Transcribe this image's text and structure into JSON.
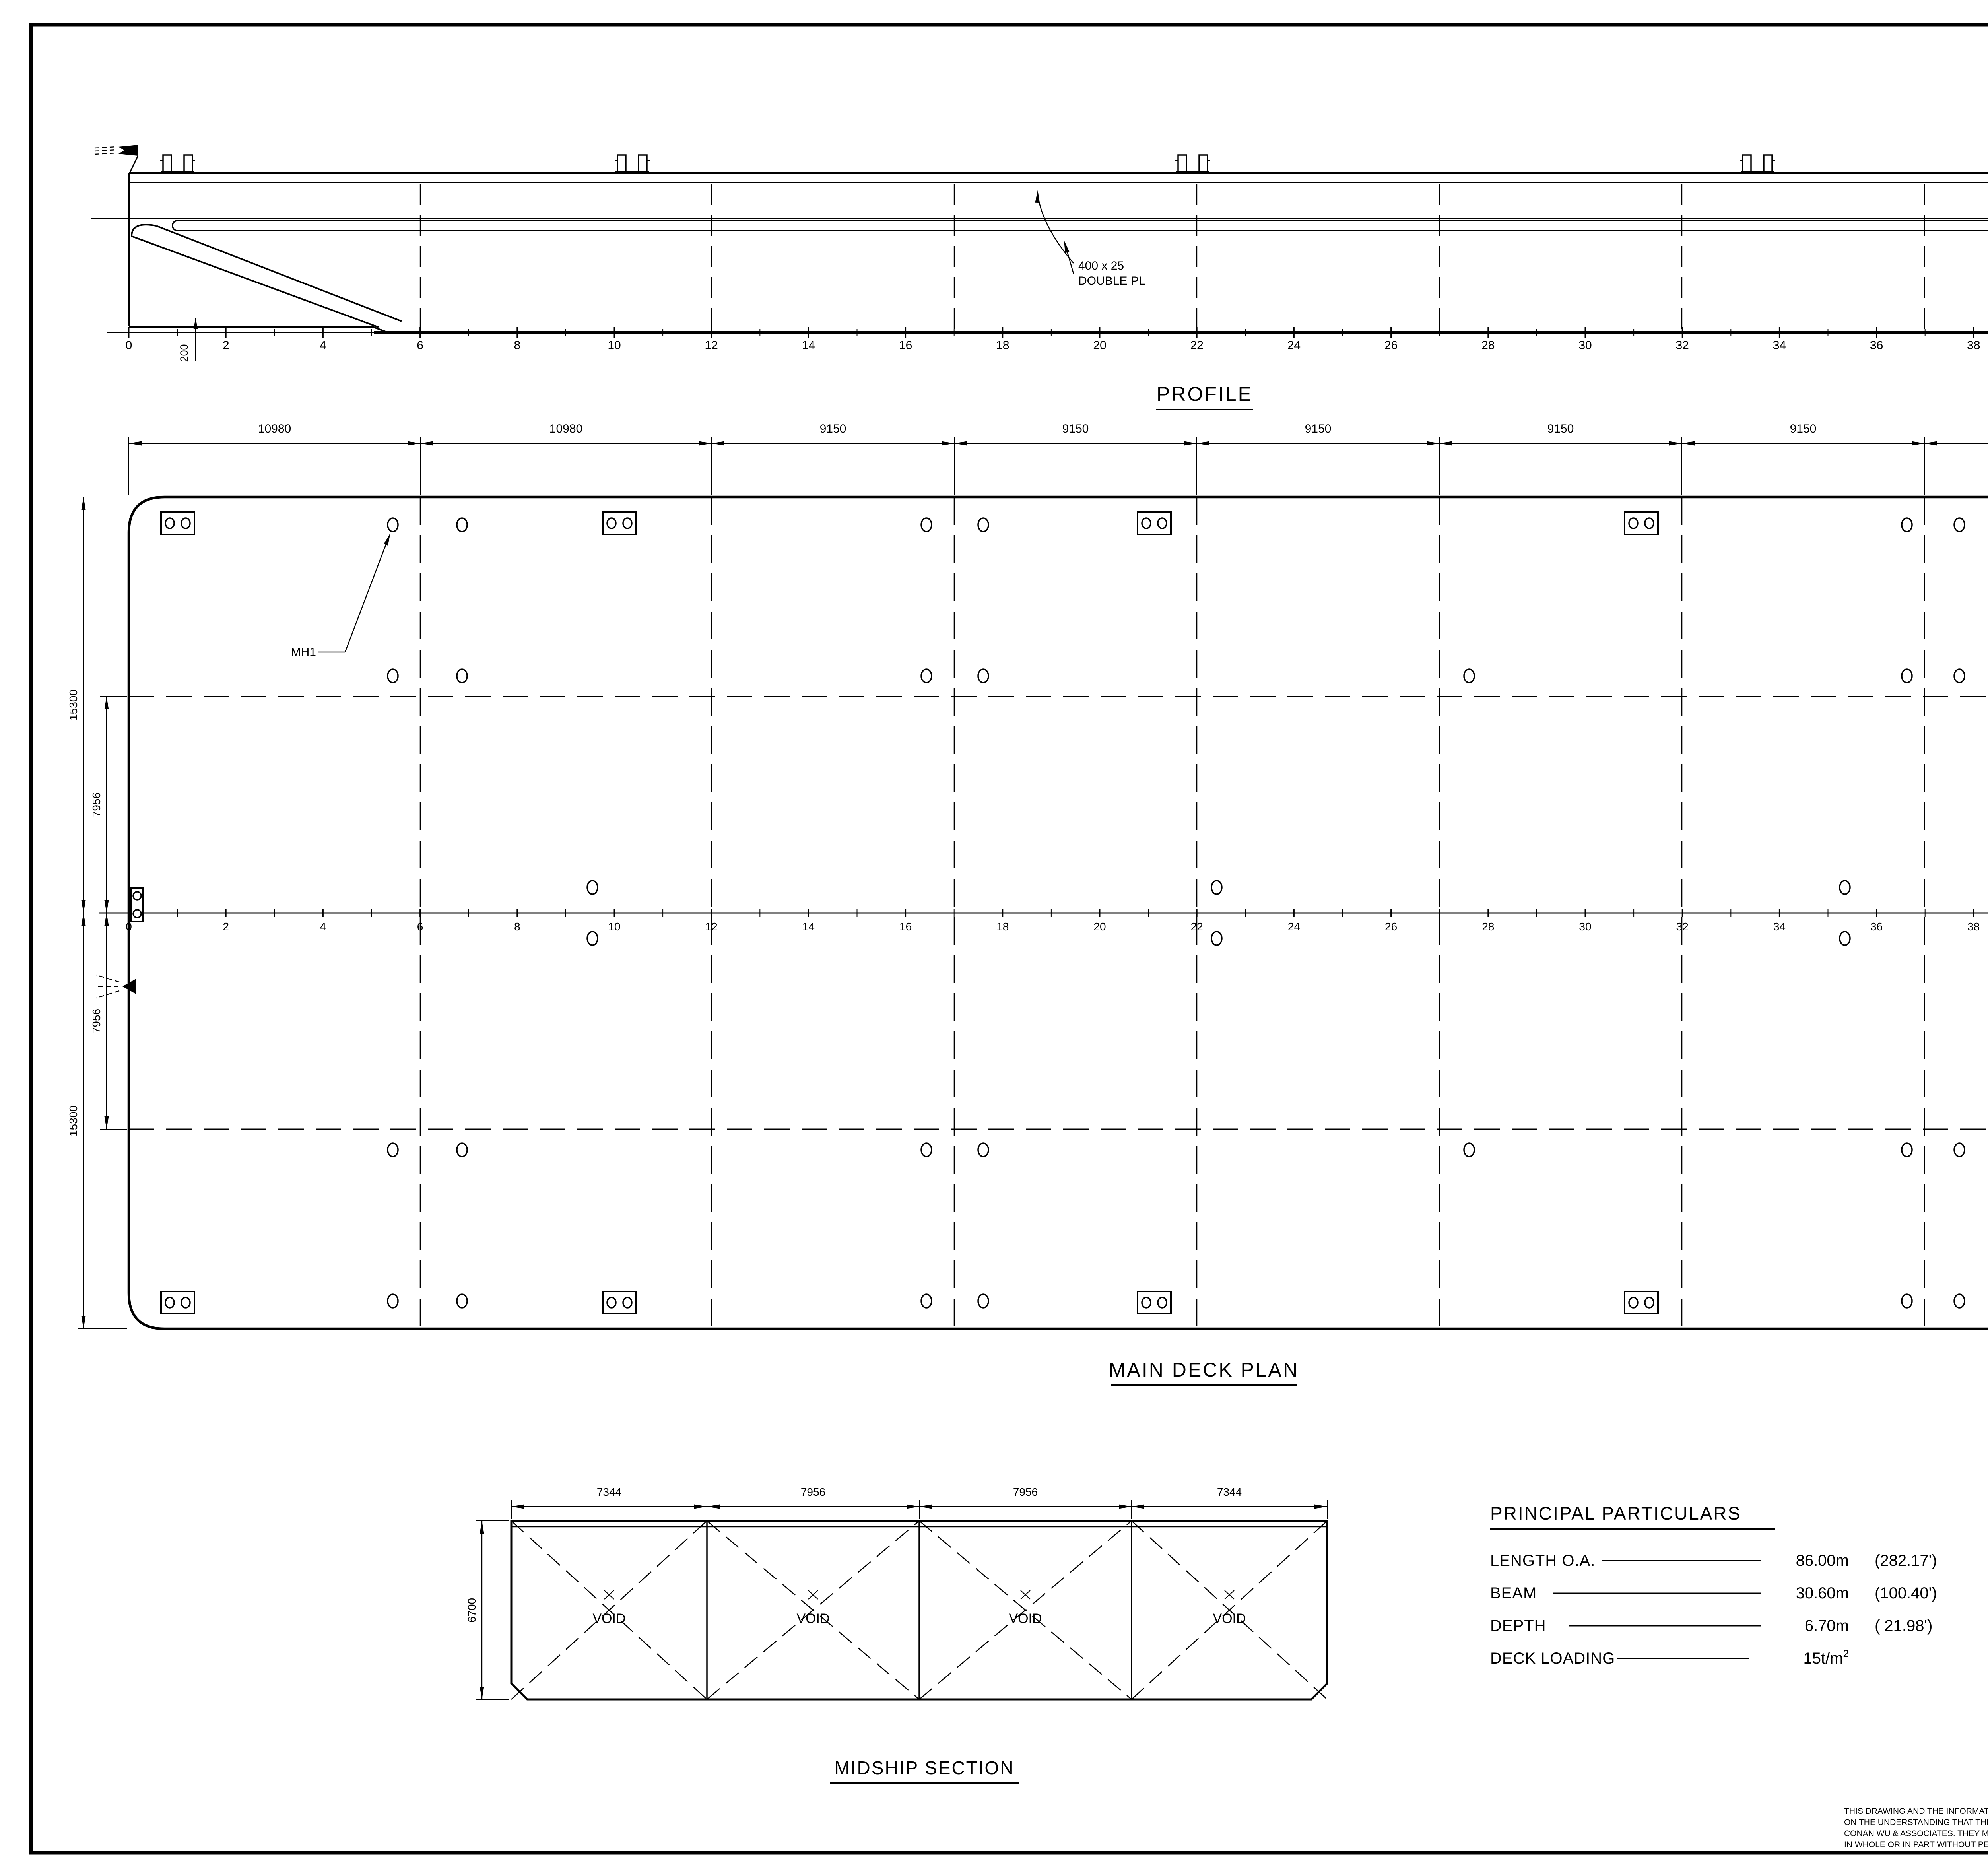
{
  "profile": {
    "title": "PROFILE",
    "double_plate_label": [
      "400 x 25",
      "DOUBLE PL"
    ],
    "stern_dim": "200"
  },
  "frame_scale": {
    "labels": [
      "0",
      "2",
      "4",
      "6",
      "8",
      "10",
      "12",
      "14",
      "16",
      "18",
      "20",
      "22",
      "24",
      "26",
      "28",
      "30",
      "32",
      "34",
      "36",
      "38",
      "40",
      "42",
      "45",
      "50"
    ]
  },
  "deck_plan": {
    "title": "MAIN DECK PLAN",
    "top_dims": [
      "10980",
      "10980",
      "9150",
      "9150",
      "9150",
      "9150",
      "9150",
      "10980",
      "7310"
    ],
    "left_dims_outer": [
      "15300",
      "15300"
    ],
    "left_dims_inner": [
      "7956",
      "7956"
    ],
    "mh1": "MH1",
    "mh36": "MH36"
  },
  "midship": {
    "title": "MIDSHIP SECTION",
    "top_dims": [
      "7344",
      "7956",
      "7956",
      "7344"
    ],
    "height_dim": "6700",
    "compartments": [
      "VOID",
      "VOID",
      "VOID",
      "VOID"
    ]
  },
  "particulars": {
    "title": "PRINCIPAL PARTICULARS",
    "rows": [
      {
        "label": "LENGTH O.A.",
        "value": "86.00m",
        "sup": "",
        "imperial": "(282.17')"
      },
      {
        "label": "BEAM",
        "value": "30.60m",
        "sup": "",
        "imperial": "(100.40')"
      },
      {
        "label": "DEPTH",
        "value": "6.70m",
        "sup": "",
        "imperial": "( 21.98')"
      },
      {
        "label": "DECK LOADING",
        "value": "15t/m",
        "sup": "2",
        "imperial": ""
      }
    ]
  },
  "title_block": {
    "revisions": [
      {
        "date": "04Jul2016",
        "modification": "Refer Lines Plan",
        "rev": "0.5",
        "by": "ND"
      },
      {
        "date": "22-12-06",
        "modification": "ADD MANHOLE POSITION",
        "rev": "1",
        "by": "SHIPYARD"
      }
    ],
    "rev_headers": {
      "date": "DATE",
      "modification": "MODIFICATION",
      "rev": "REV",
      "by": "BY"
    },
    "ship_label": "SHIP:",
    "ship_name": "86m DECK CARGO BARGE",
    "title_label": "TITLE:",
    "drawing_title": "GENERAL ARRANGEMENT",
    "yard_no_label": "YARD NO.",
    "class_label": "CLASS",
    "class_value": "BV",
    "company": {
      "name": "CONAN WU & ASSOCIATES",
      "type": "NAVAL    ARCHITECTS",
      "address": "INFORMATICS BLDG., 5 INTERNATIONAL BUSINESS PARK, JURONG EAST, SINGAPORE 609914",
      "contact": "TEL. : (65) 6562-1138    FAX : (65) 6562-1238, (65) 6562-0123    E-MAIL : mail@cwa.com.sg"
    },
    "table_headers": [
      "DRAWN",
      "CHECKED",
      "APPROVED",
      "SCALE",
      "DRAWING NO.",
      "REV"
    ],
    "drawn": "CHUA/LUA",
    "checked": "CHUA",
    "approved": "",
    "drawn_date": "10-01-05",
    "checked_date": "11-01-05",
    "scale": "1:125",
    "drawing_no": "C3961/G-1",
    "rev": "0.5"
  },
  "disclaimer": {
    "lines": [
      "THIS DRAWING AND THE INFORMATION CONTAINED HEREIN ARE SUPPLIED",
      "ON THE UNDERSTANDING THAT THEY ARE THE EXCLUSIVE PROPERTY OF",
      "CONAN WU & ASSOCIATES. THEY MUST NOT BE USED OR REPRODUCED",
      "IN WHOLE OR IN PART WITHOUT PERMISSION IN WRITING."
    ]
  }
}
